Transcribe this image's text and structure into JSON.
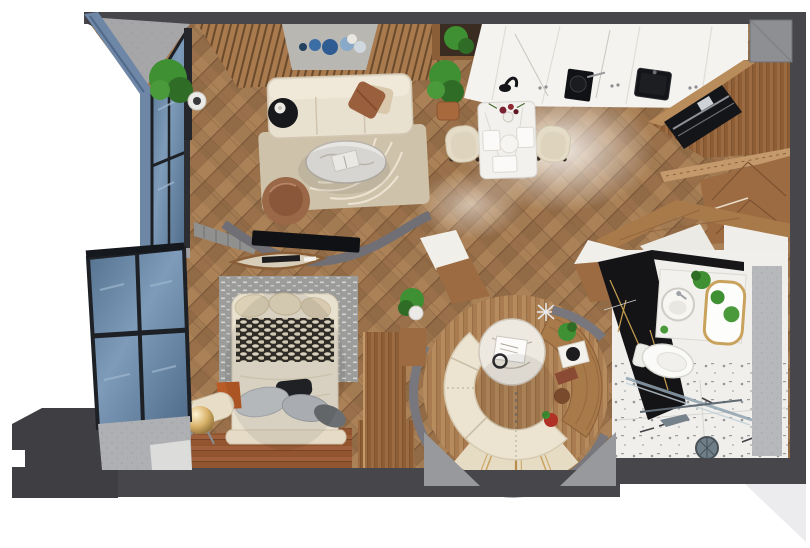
{
  "scene": {
    "type": "3d-floor-plan-render",
    "description": "Top-down 3D render of a small studio apartment with living room, kitchen with dining set, bedroom, circular lounge nook and bathroom",
    "canvas": {
      "width": 810,
      "height": 548
    },
    "rooms": [
      {
        "name": "living-room",
        "objects": [
          "wood-slat-accent-wall",
          "gray-panel-with-blue-plates",
          "cream-sofa",
          "brown-pillow",
          "black-side-table",
          "beige-rug",
          "oval-marble-coffee-table",
          "leather-pouf",
          "tv-on-curved-partition",
          "curtains"
        ]
      },
      {
        "name": "kitchen",
        "objects": [
          "white-marble-counter",
          "black-cooktop",
          "black-sink",
          "black-faucet",
          "wood-wall-niche-with-plant"
        ]
      },
      {
        "name": "dining-area",
        "objects": [
          "white-marble-table",
          "two-cream-chairs",
          "flower-vase",
          "place-settings",
          "potted-plant"
        ]
      },
      {
        "name": "bedroom",
        "objects": [
          "bed-with-cream-duvet",
          "woven-pattern-throw",
          "gray-pillows",
          "black-pillow",
          "gray-graphic-rug",
          "bolster-bench",
          "gold-sphere-lamp",
          "wood-wardrobe",
          "red-brown-plank-floor"
        ]
      },
      {
        "name": "circular-lounge",
        "objects": [
          "curved-cream-banquette",
          "round-marble-table",
          "curved-wood-console",
          "decor-items",
          "gold-inlay-tile-floor"
        ]
      },
      {
        "name": "bathroom",
        "objects": [
          "black-marble-wall",
          "white-vanity",
          "round-sink",
          "gold-frame-mirror",
          "toilet",
          "glass-shower",
          "shower-head",
          "marble-tile-floor"
        ]
      },
      {
        "name": "entry",
        "objects": [
          "light-tile-floor",
          "angled-wood-partitions"
        ]
      },
      {
        "name": "balcony",
        "objects": [
          "blue-glass-windows",
          "black-frames",
          "gray-sill-floor"
        ]
      },
      {
        "name": "storage",
        "objects": [
          "tall-wood-cabinet",
          "black-built-in-appliance",
          "chevron-wood-wardrobe",
          "wood-shelf"
        ]
      }
    ],
    "palette": {
      "wall_dark": "#46464b",
      "wall_mid": "#77777d",
      "wall_light": "#b7b8bb",
      "concrete": "#a6a6a8",
      "wood_floor": "#a87c50",
      "wood_cabinet": "#9c6b42",
      "plank_red": "#9c5c38",
      "marble_white": "#f2f1ee",
      "marble_black": "#141417",
      "cream_upholstery": "#e9e1d0",
      "rug_beige": "#cec2ab",
      "rug_gray": "#9c9c9a",
      "glass_blue": "#5f7ea1",
      "wall_blue": "#6e87a7",
      "plant_green": "#3f8f33",
      "gold": "#c9a25e",
      "background": "#ffffff"
    }
  }
}
